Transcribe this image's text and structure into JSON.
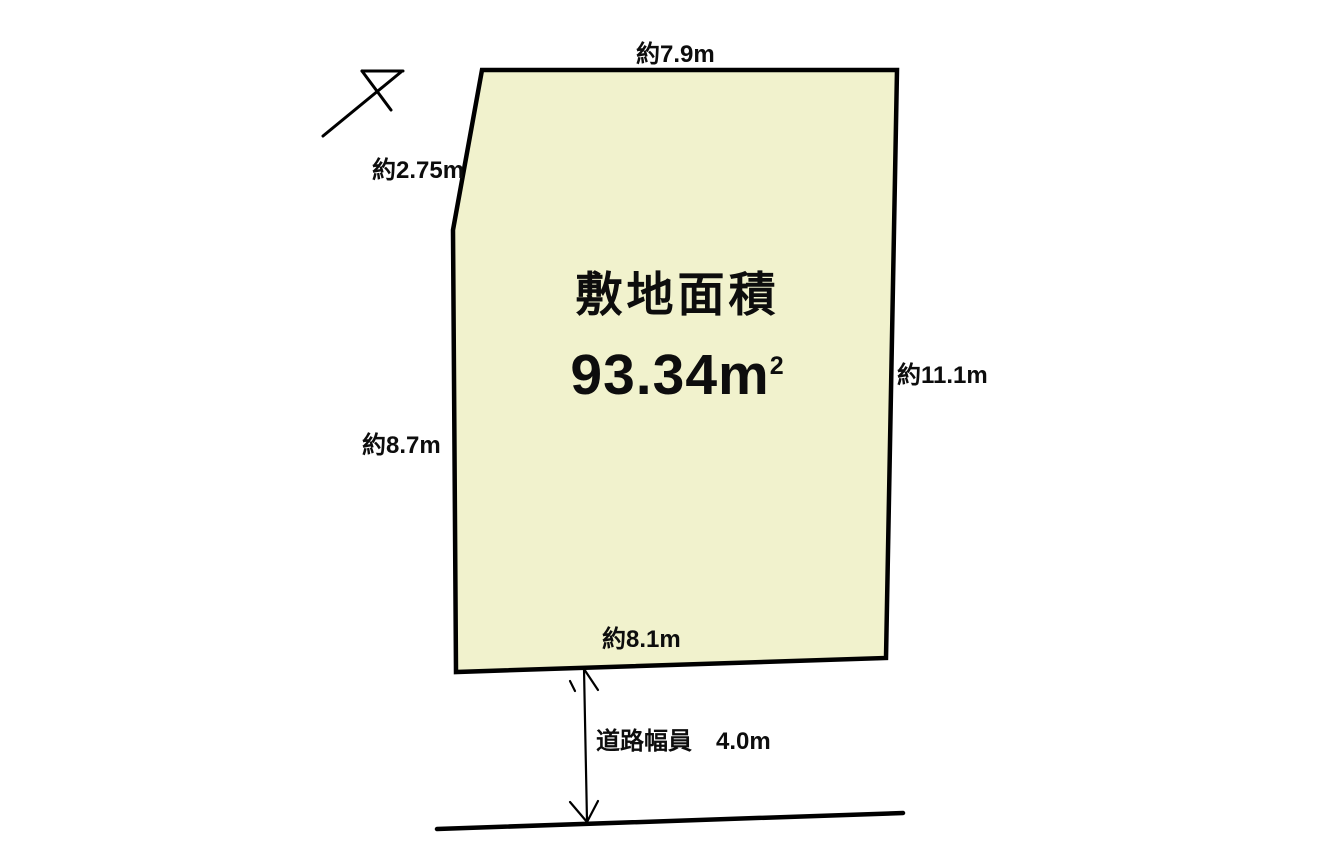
{
  "parcel": {
    "area_title": "敷地面積",
    "area_value": "93.34m",
    "area_sup": "2",
    "fill_color": "#f1f2cd",
    "outline_color": "#000000"
  },
  "dimensions": {
    "top": "約7.9m",
    "upper_left": "約2.75m",
    "left": "約8.7m",
    "right": "約11.1m",
    "bottom": "約8.1m"
  },
  "road": {
    "width_label": "道路幅員　4.0m"
  },
  "icons": {
    "north_arrow": "north-arrow-icon"
  }
}
